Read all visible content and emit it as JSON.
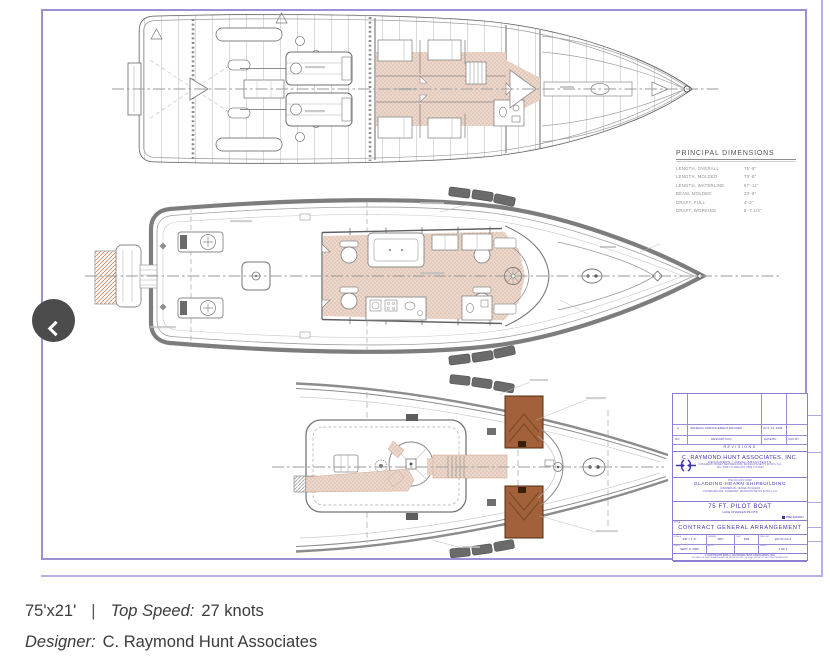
{
  "colors": {
    "sheet_border": "#9d90d6",
    "titleblock_ink": "#4336b4",
    "titleblock_line": "#8b7dd0",
    "drawing_line": "#6f6f6f",
    "accommodation_fill": "#ecd7cb",
    "platform_brown": "#a2613b",
    "fender_gray": "#6b6b6b",
    "prev_button_bg": "#4b4b4b"
  },
  "icons": {
    "prev_button": "chevron-left"
  },
  "dimensions": {
    "title": "PRINCIPAL DIMENSIONS",
    "rows": [
      {
        "label": "LENGTH, OVERALL",
        "value": "75'-8\""
      },
      {
        "label": "LENGTH, MOLDED",
        "value": "73'-8\""
      },
      {
        "label": "LENGTH, WATERLINE",
        "value": "67'-11\""
      },
      {
        "label": "BEAM, MOLDED",
        "value": "20'-6\""
      },
      {
        "label": "DRAFT, FULL",
        "value": "4'-2\""
      },
      {
        "label": "DRAFT, WORKING",
        "value": "6'-7 1/2\""
      }
    ]
  },
  "revisions": {
    "title": "REVISIONS",
    "headers": {
      "no": "NO.",
      "description": "DESCRIPTION",
      "date": "DATE/BY",
      "chk": "CHK BY"
    },
    "rows": [
      {
        "no": "A",
        "description": "GENERAL ARRANGEMENT REVISED",
        "date": "OCT. 23, 2008",
        "chk": ""
      }
    ]
  },
  "titleblock": {
    "company": "C. RAYMOND HUNT ASSOCIATES, INC.",
    "company_sub": "DESIGNERS / NAVAL ARCHITECTS",
    "company_addr1": "CONGRESS STREET   NEW BEDFORD, MASSACHUSETTS 02740 U.S.A.",
    "company_addr2": "TEL: (508) 717-0600    FAX: (508) 717-0620",
    "yard_small": "THE DUCLOS CORP.",
    "yard": "GLADDING-HEARN SHIPBUILDING",
    "yard_sub": "COMMERCIAL VESSEL BUILDERS",
    "yard_addr": "1 RIVERSIDE AVE.  SOMERSET, MASSACHUSETTS 02726 U.S.A.",
    "project": "75 FT. PILOT BOAT",
    "project_sub": "LAKE CHARLES PILOTS",
    "stamp": "PRELIMINARY",
    "title_corner": "TITLE",
    "drawing_title": "CONTRACT GENERAL ARRANGEMENT",
    "fields": {
      "scale_label": "SCALE",
      "scale": "3/8\" = 1'-0\"",
      "drawn_label": "DRAWN",
      "drawn": "RFP",
      "check_label": "CHK",
      "check": "DLB",
      "dwg_label": "DWG NO.",
      "dwg": "207-01  GA-1",
      "date_label": "DATE",
      "date": "SEPT. 8, 2008",
      "appd_label": "APPD",
      "appd": "",
      "blank_label": "",
      "blank": "",
      "sheet_label": "SHEET",
      "sheet": "1 OF 1"
    },
    "copyright": "© COPYRIGHT 2008  C. RAYMOND HUNT ASSOCIATES, INC.",
    "legal": "NO PART OF THIS DRAWING MAY BE REPRODUCED OR USED WITHOUT WRITTEN PERMISSION."
  },
  "caption": {
    "dimensions": "75'x21'",
    "separator": "|",
    "speed_label": "Top Speed:",
    "speed_value": "27 knots",
    "designer_label": "Designer:",
    "designer_value": "C. Raymond Hunt Associates"
  }
}
